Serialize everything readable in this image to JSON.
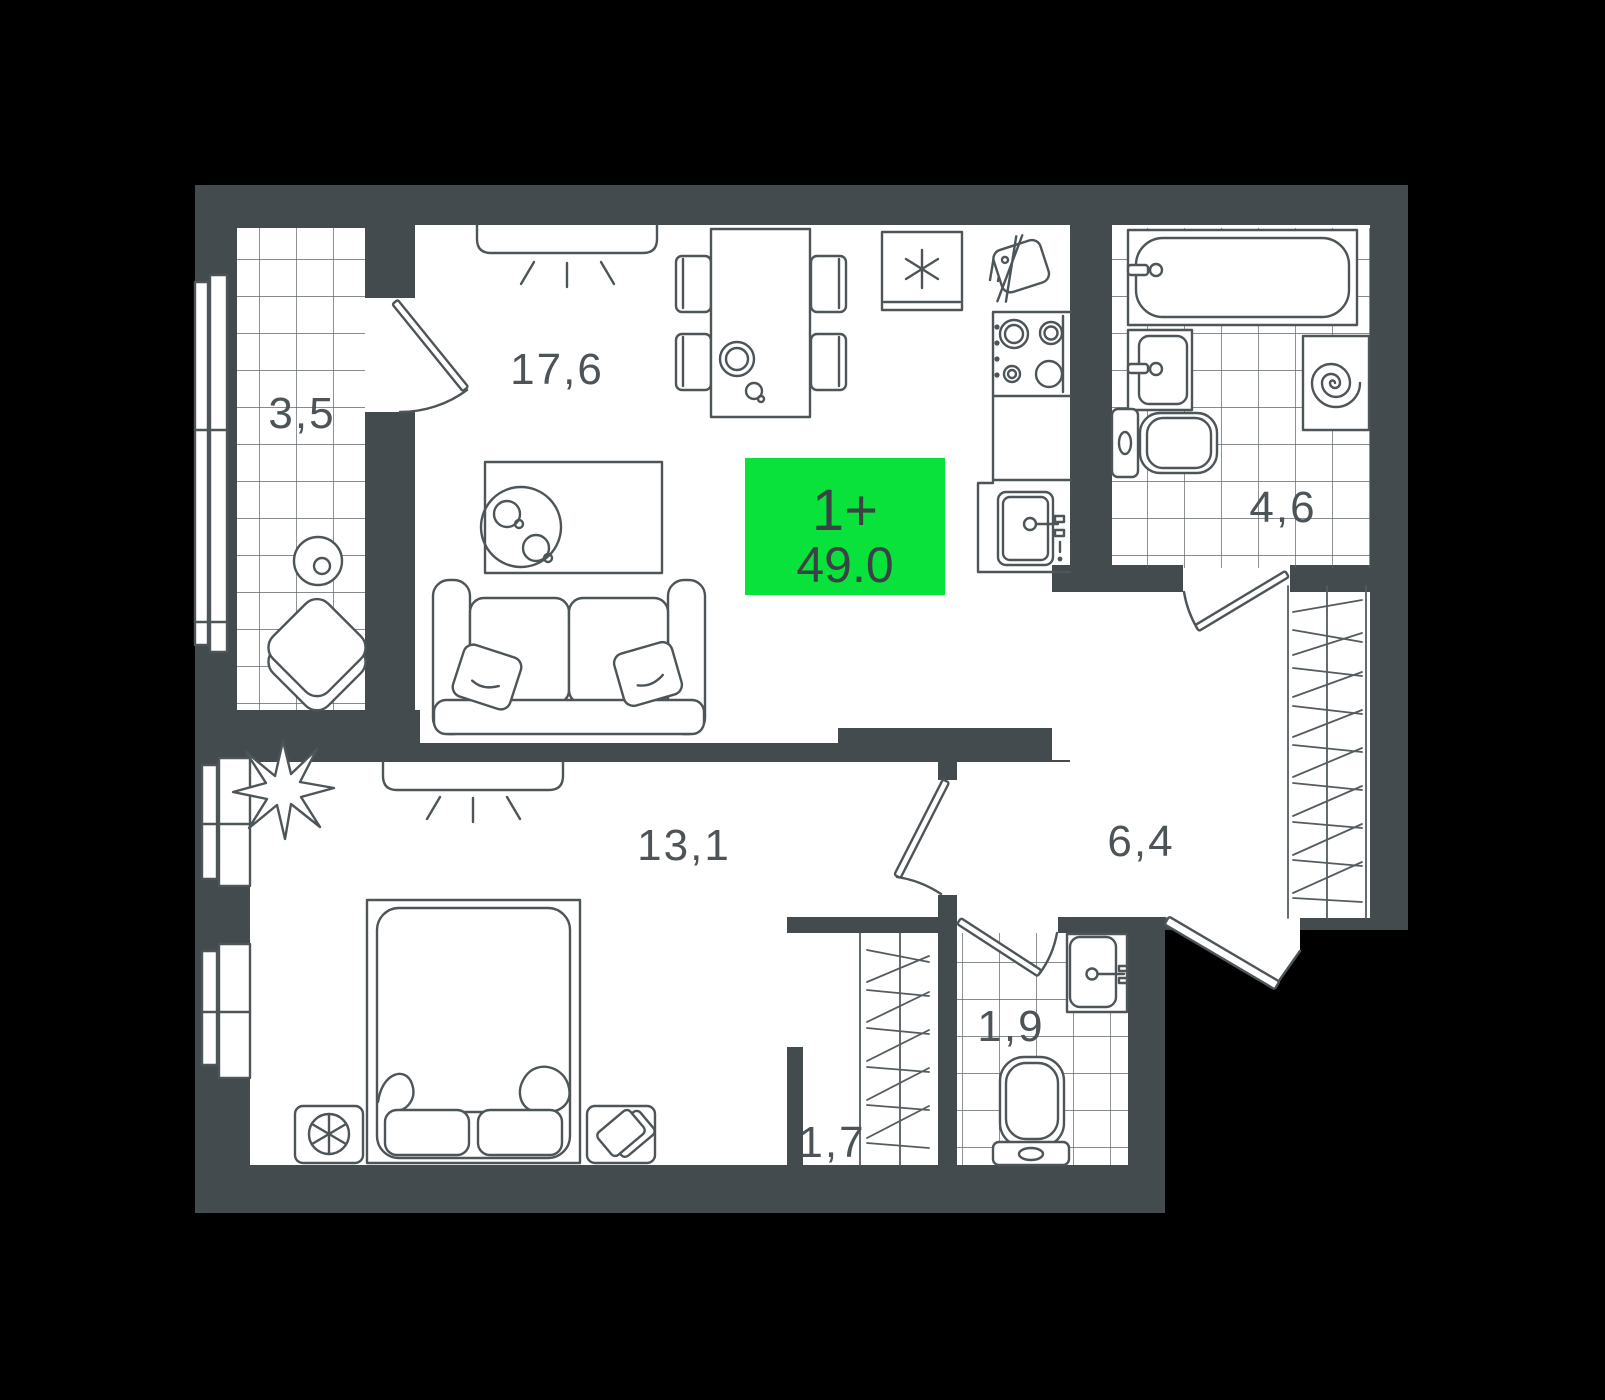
{
  "floorplan": {
    "badge": {
      "type_label": "1+",
      "area_value": "49.0"
    },
    "rooms": {
      "living_kitchen": "17,6",
      "loggia": "3,5",
      "bathroom": "4,6",
      "hall": "6,4",
      "bedroom": "13,1",
      "wc": "1,9",
      "closet": "1,7"
    },
    "colors": {
      "background": "#000000",
      "walls": "#434B4E",
      "floor": "#FFFFFF",
      "outline": "#4D5559",
      "accent_green": "#08E23B",
      "label_text": "#4C5458"
    }
  }
}
